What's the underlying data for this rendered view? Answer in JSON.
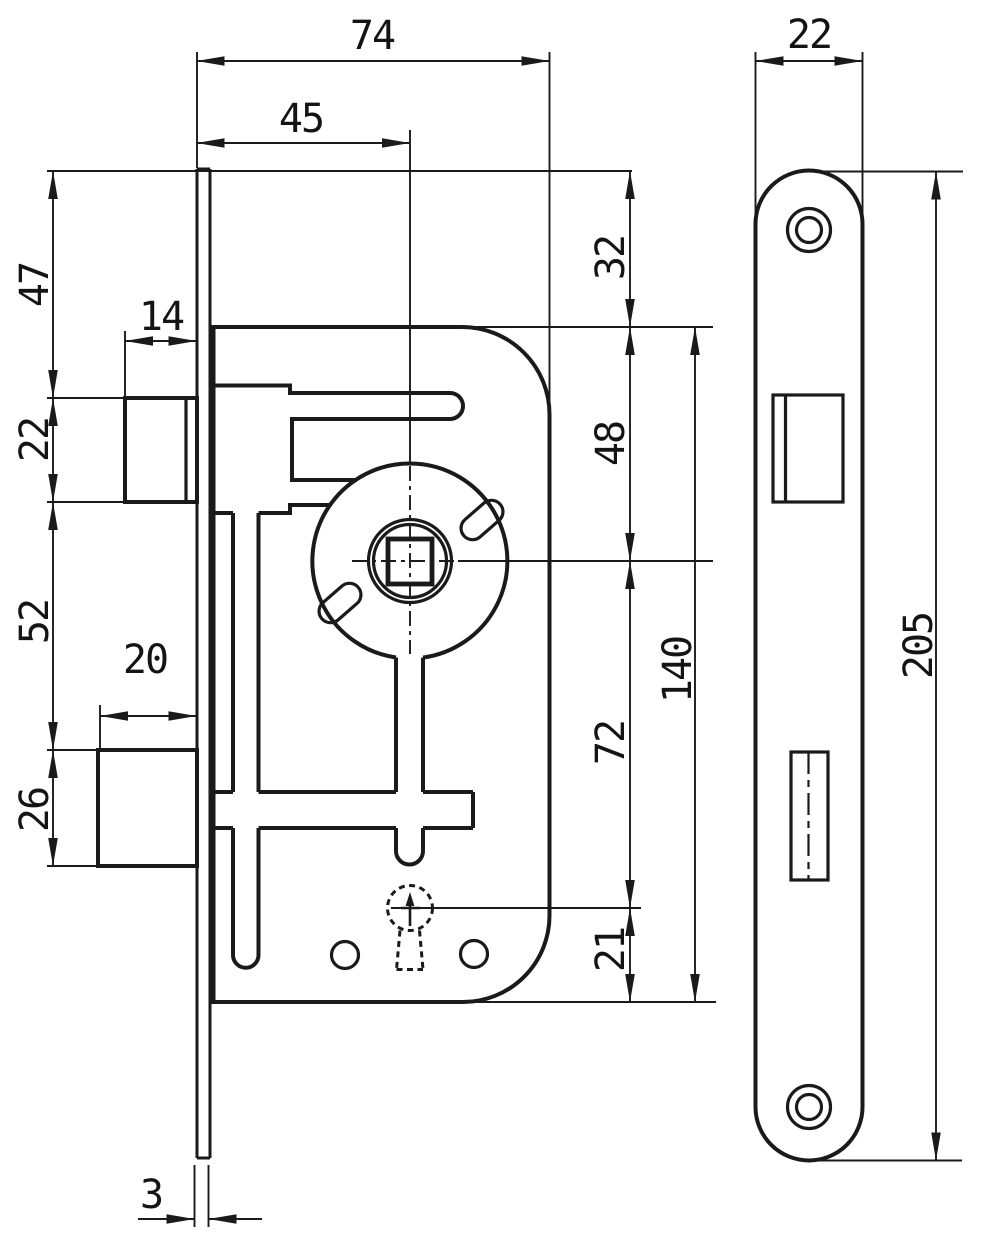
{
  "drawing": {
    "ink_color": "#1a1a1a",
    "background_color": "#ffffff",
    "dimensions": {
      "overall_width": "74",
      "backset": "45",
      "faceplate_width": "22",
      "top_to_case": "32",
      "top_to_latch": "47",
      "latch_protrusion": "14",
      "latch_height": "22",
      "latch_to_bolt": "52",
      "bolt_protrusion": "20",
      "bolt_height": "26",
      "case_to_spindle": "48",
      "spindle_to_keyhole": "72",
      "case_height": "140",
      "keyhole_to_bottom": "21",
      "faceplate_thickness": "3",
      "faceplate_length": "205"
    }
  }
}
